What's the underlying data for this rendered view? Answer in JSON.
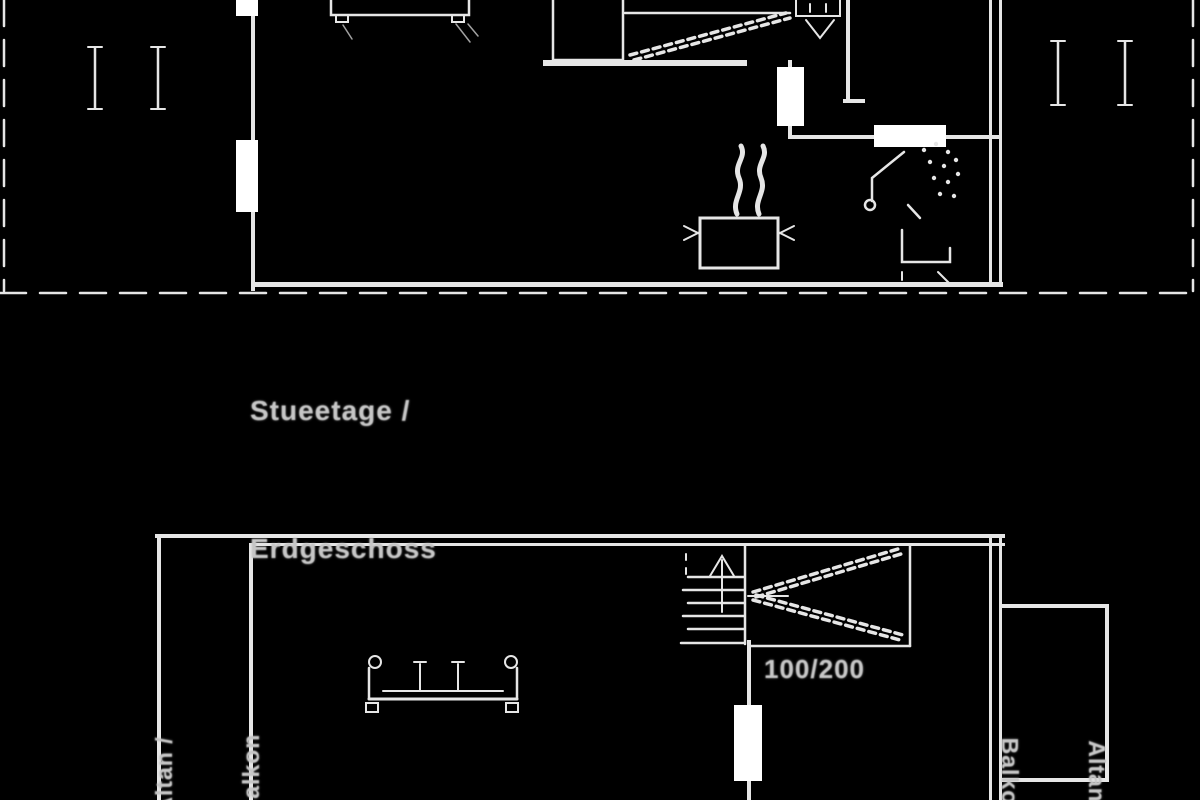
{
  "document": {
    "type": "floor-plan-drawing",
    "background_color": "#000000",
    "line_color": "#e6e6e6",
    "text_color": "#c6c6c6",
    "opening_fill_color": "#ffffff"
  },
  "upper_plan": {
    "floor_label_line1": "Stueetage /",
    "floor_label_line2": "Erdgeschoss",
    "icons": [
      "sofa-icon",
      "closet",
      "staircase-icon",
      "toilet-icon",
      "shower-icon",
      "stove-pot-icon",
      "window-icon"
    ]
  },
  "lower_plan": {
    "bed_size_label": "100/200",
    "left_balcony": {
      "label_line1": "Altan /",
      "label_line2": "Balkon"
    },
    "right_balcony": {
      "label_line1": "Altan /",
      "label_line2": "Balkon"
    },
    "icons": [
      "sofa-icon",
      "staircase-icon",
      "loft-bed-hatch",
      "door-opening"
    ]
  }
}
